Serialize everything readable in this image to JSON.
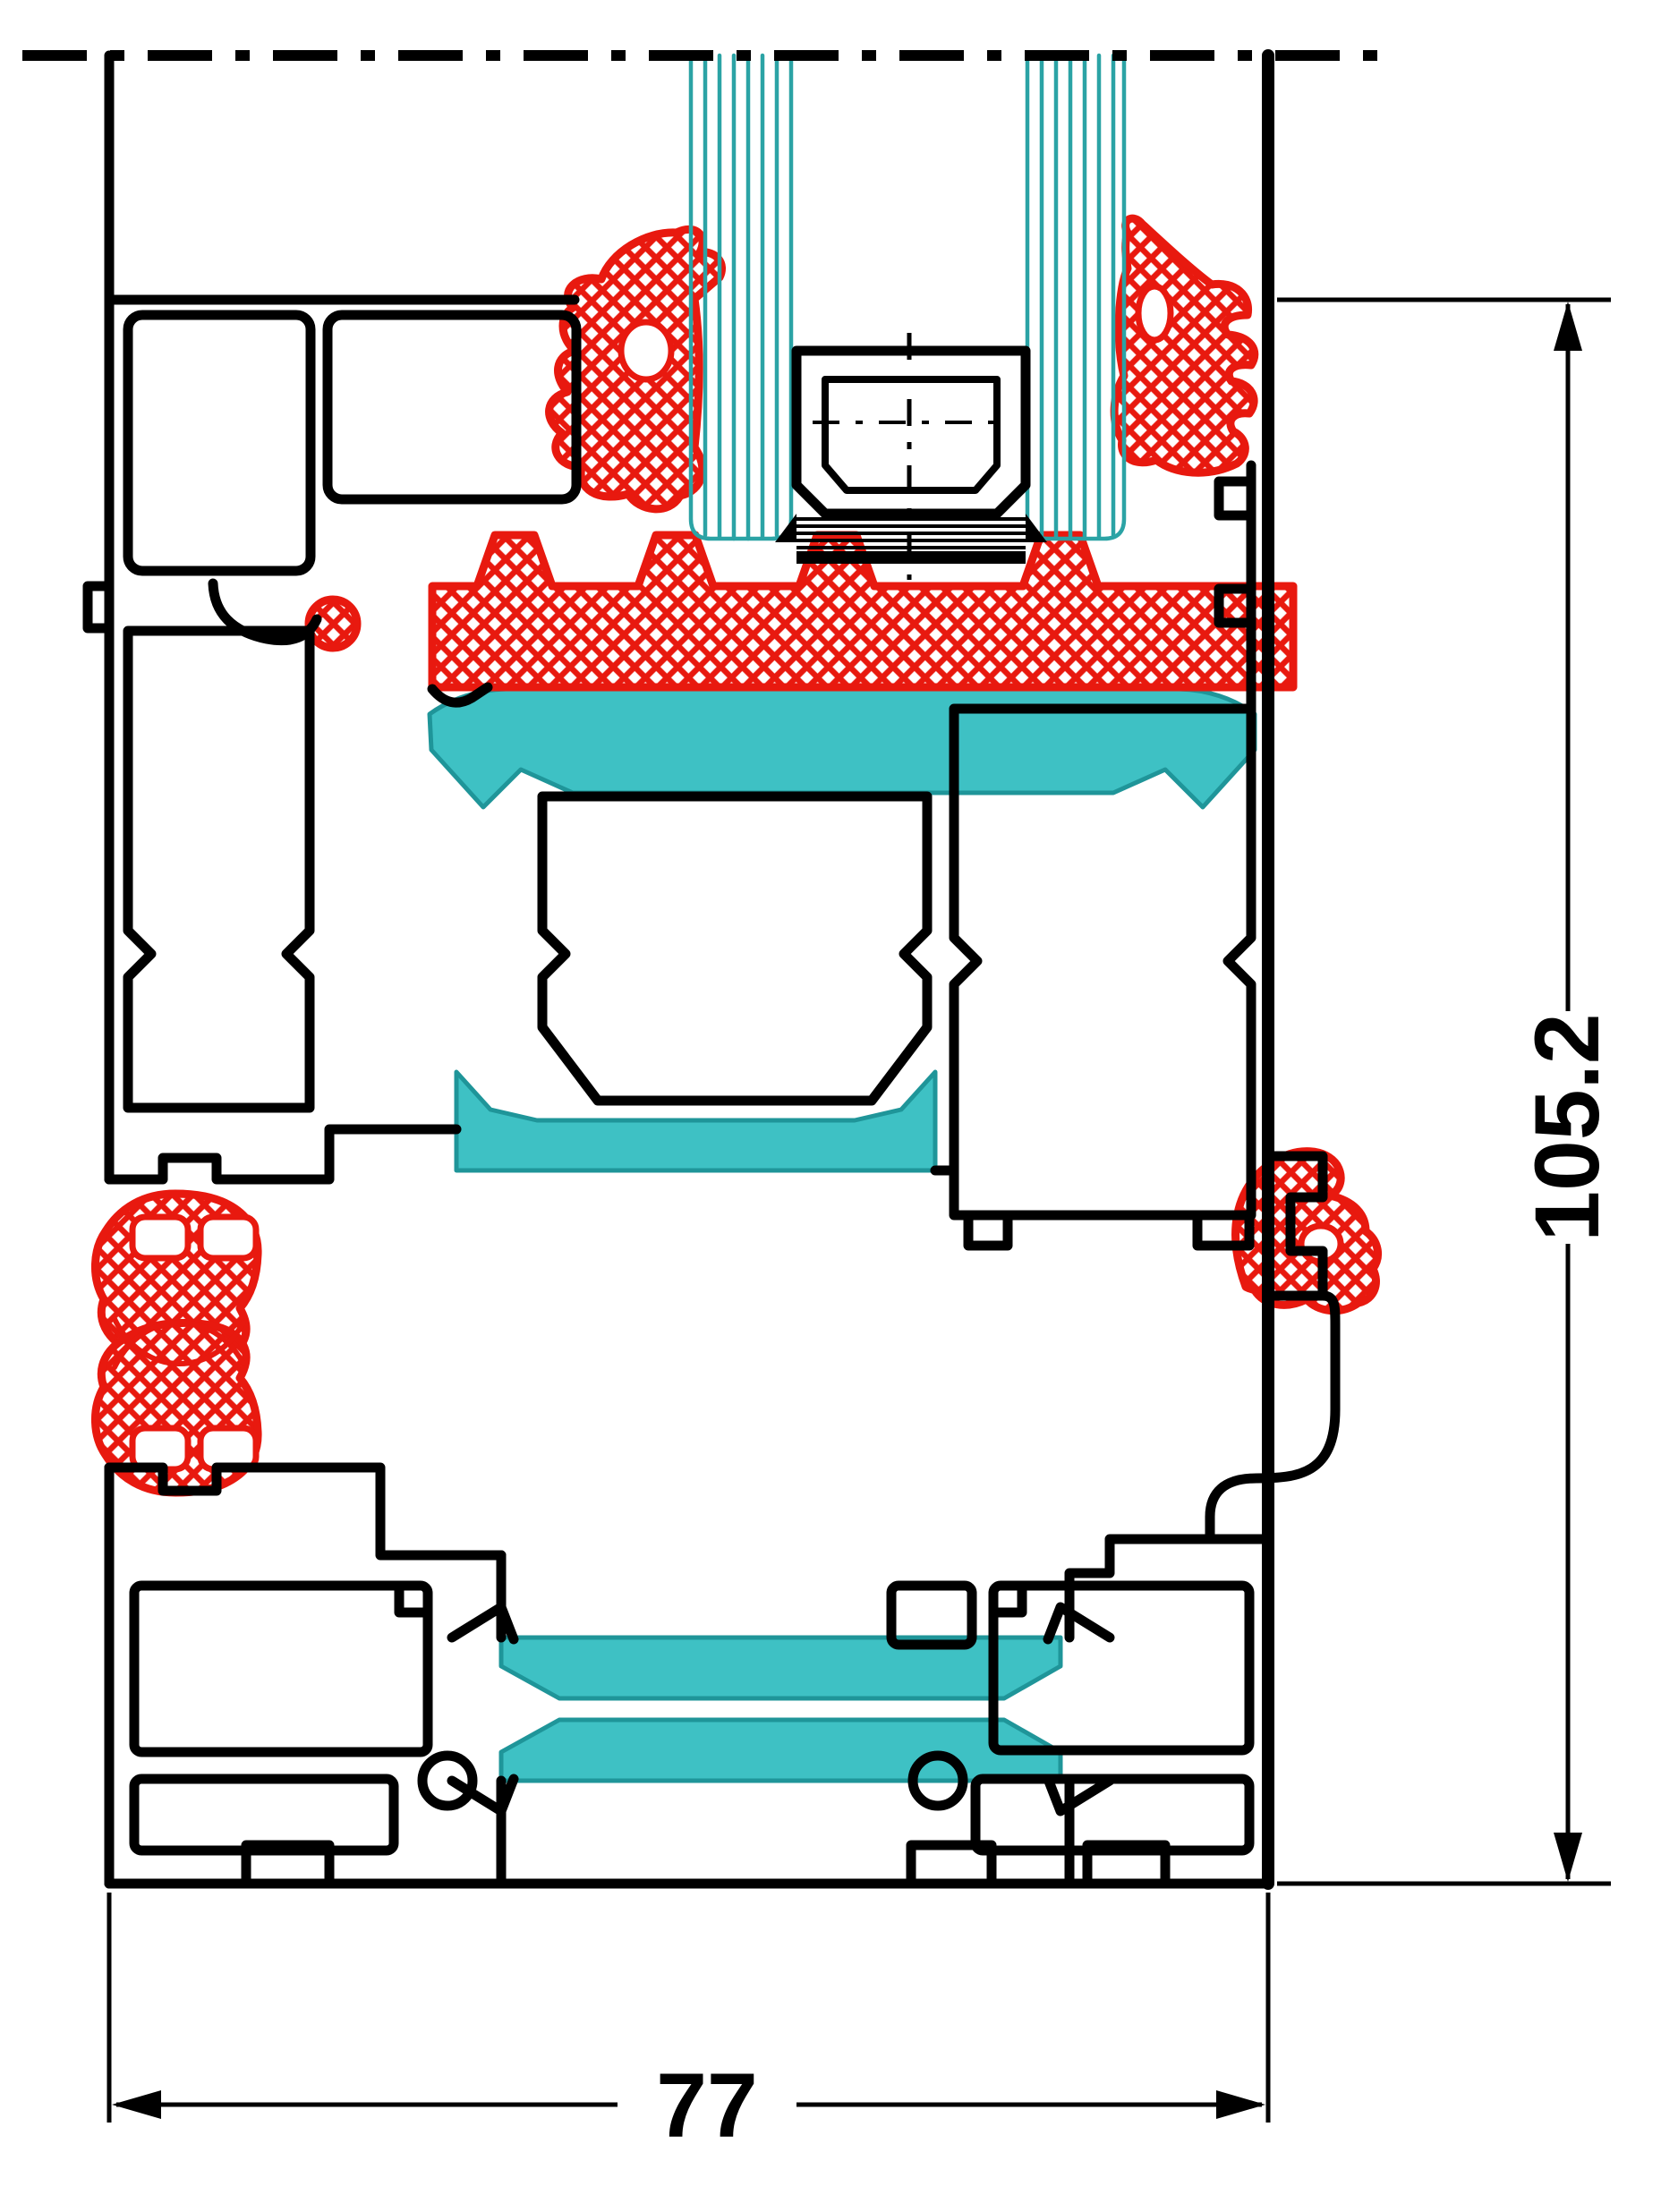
{
  "title": "Aluminium window profile cross-section drawing",
  "annotations": {
    "height_label": "105.2",
    "width_label": "77"
  },
  "colors": {
    "outline": "#000000",
    "gasket_red": "#e8190f",
    "thermal_teal": "#3ec1c4",
    "glass_teal": "#2ba3a5",
    "background": "#ffffff"
  }
}
